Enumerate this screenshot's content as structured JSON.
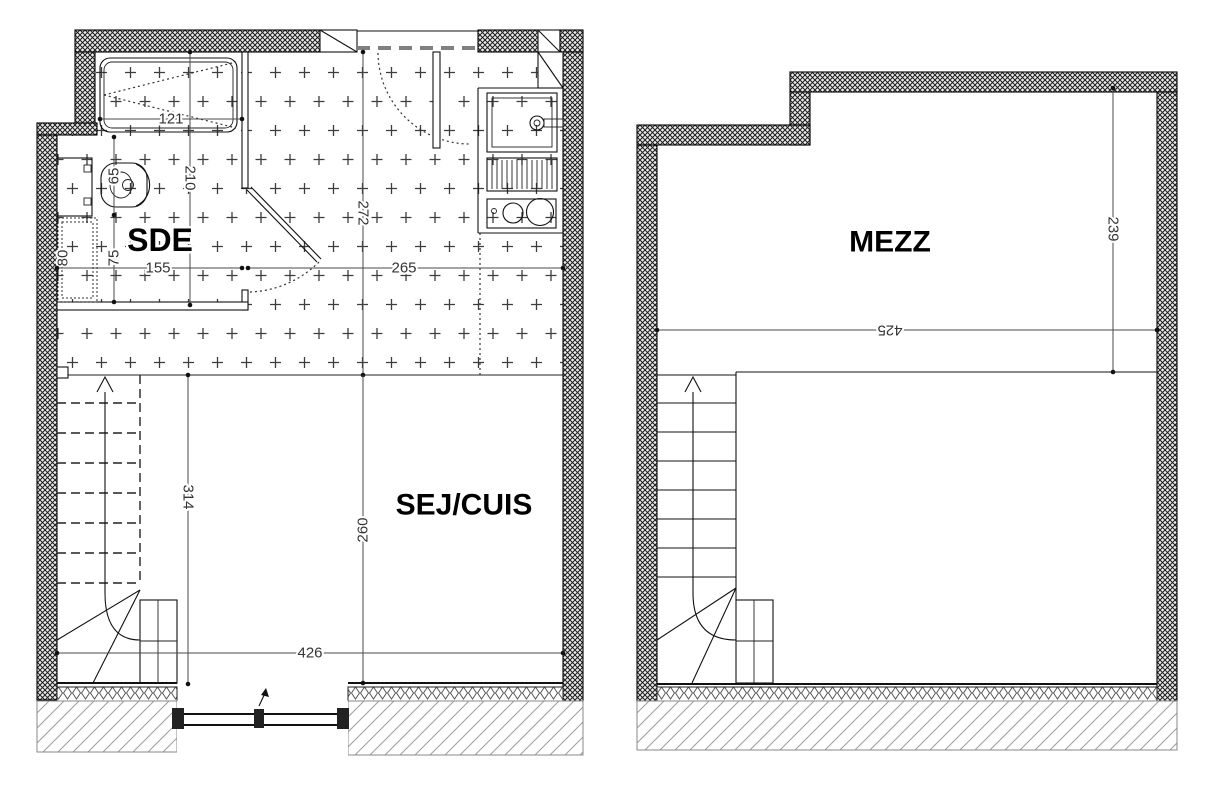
{
  "ground_floor": {
    "room_sde": "SDE",
    "room_sej": "SEJ/CUIS",
    "dims": {
      "shower_width": "121",
      "sde_depth": "210",
      "wc_offset": "65",
      "wc_clearance": "75",
      "side_clearance": "80",
      "sde_width": "155",
      "kitchen_width": "265",
      "entry_depth": "272",
      "stair_depth": "314",
      "living_depth": "260",
      "living_width": "426"
    }
  },
  "mezzanine": {
    "room": "MEZZ",
    "dims": {
      "depth": "239",
      "width": "425"
    }
  }
}
